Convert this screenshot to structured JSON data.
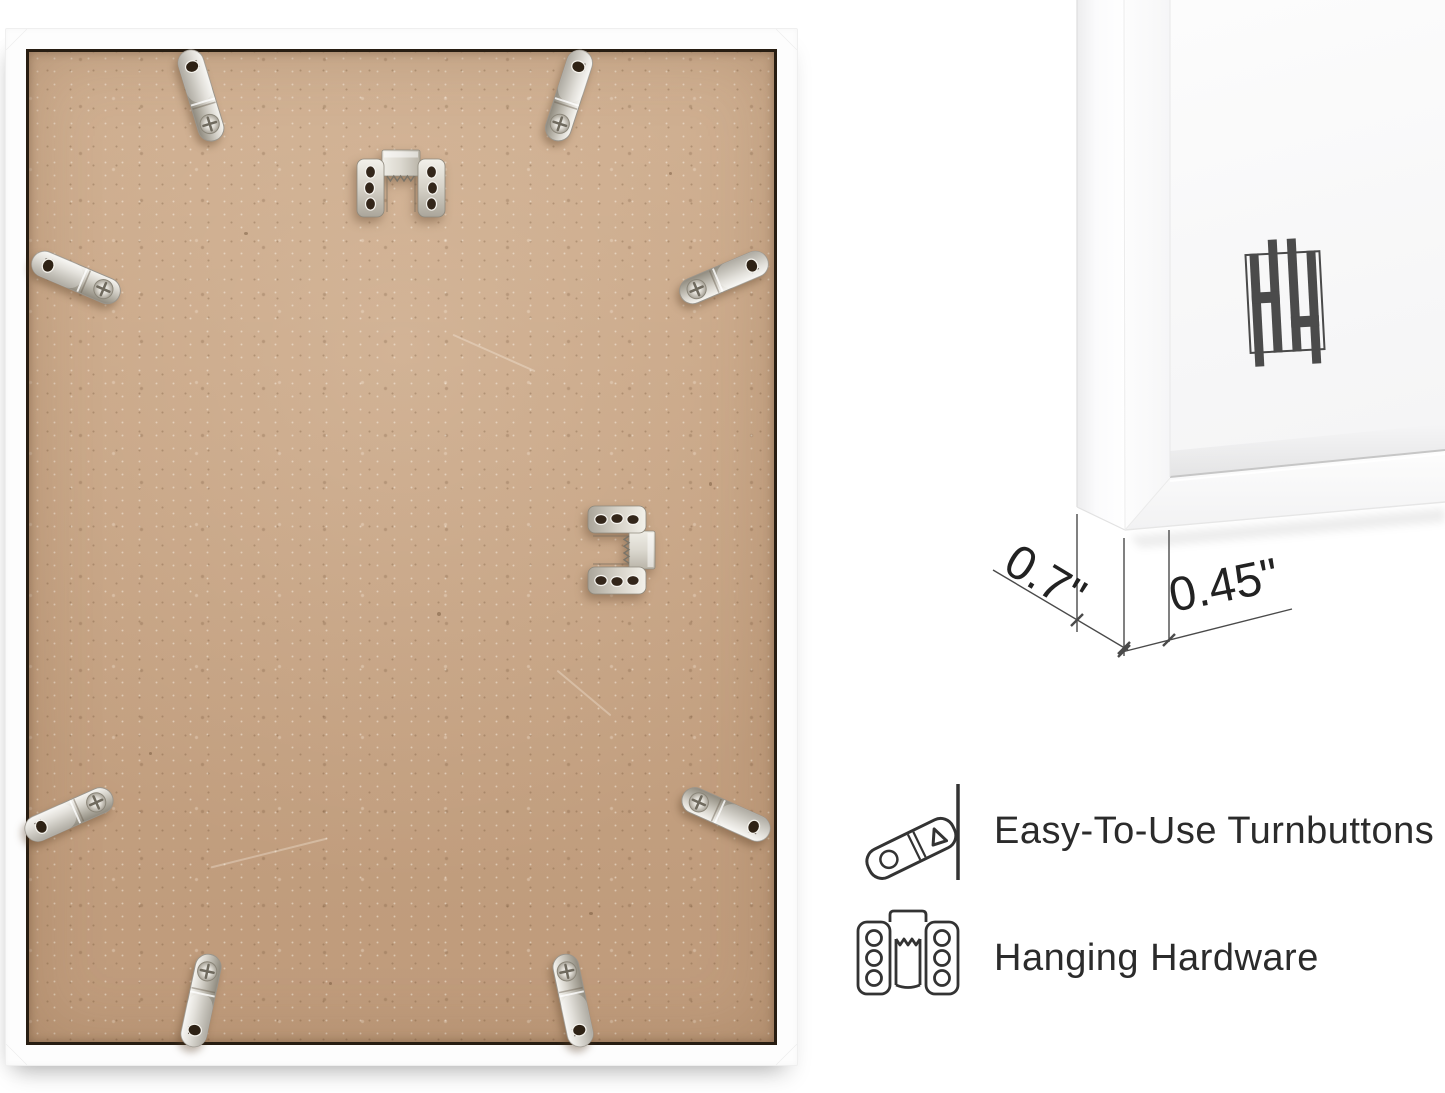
{
  "photo": {
    "subject": "frame-back-photo",
    "hardware": {
      "turnbutton_count": 8,
      "hanging_hardware_count": 2
    }
  },
  "corner_view": {
    "subject": "frame-corner-photo",
    "logo": "hh-monogram-logo"
  },
  "dimensions": {
    "depth_label": "0.7\"",
    "face_label": "0.45\""
  },
  "features": [
    {
      "icon": "turnbutton-icon",
      "label": "Easy-To-Use Turnbuttons"
    },
    {
      "icon": "hanging-hardware-icon",
      "label": "Hanging Hardware"
    }
  ],
  "colors": {
    "mdf_board": "#c8a585",
    "frame": "#ffffff",
    "metal": "#d8d5cd",
    "annotation_line": "#4a4a4a",
    "label_text": "#2b2b2b",
    "logo": "#4b4b4b"
  }
}
